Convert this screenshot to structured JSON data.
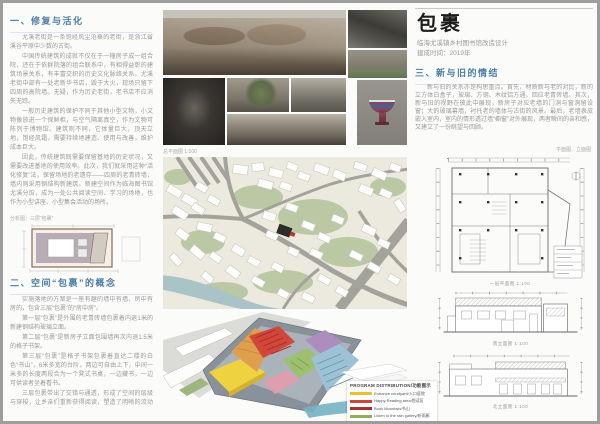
{
  "header": {
    "title": "包裹",
    "subtitle": "临海尤溪镇乡村图书馆改造设计",
    "completion": "建成时间：2019年"
  },
  "section1": {
    "heading": "一、修复与活化",
    "paragraphs": [
      "尤溪老街是一条饱经风尘沧桑的老街，是浙江省溪谷平原中少数的古街。",
      "中国传统建筑的成就不仅在于一幢房子成一组合院，还在于依群院落的组合联系中，有相得益彰的建筑场景关系，有丰富交织的历史文化脉络关系。尤溪老街中部有一处老新华书店，毁于大火，现场只留下四周的高院墙。无疑，作为历史老街，老书店不应消失无踪。",
      "一般历史建筑的保护不同于其他小型文物，小文物像放进一个保鲜柜，与空气隔离真空，作为文物可陈列于博物馆。建筑则不同，它体量巨大，顶天立地，饱经风霜，需要持续地建造、使用与改善，维护成本巨大。",
      "因此，传统建筑既需要保留基地的历史状况，又需要改进基地的使用效率。此次，我们就采用这种“活化修复”法，保留场地的老遗存——四周的老青砖墙，墙内则采用钢结构新建筑。新建空间作为临海图书馆尤溪分馆，成为一处公共阅读空间、学习的场地，也作为小型讲座、小型集会活动的场所。"
    ],
    "diagram_caption": "分析图：三层“包裹”"
  },
  "section2": {
    "heading": "二、空间“包裹”的概念",
    "paragraphs": [
      "实施落地的方案是一座有趣的墙中有墙、房中有房的，包含三层“包裹”的“房中房”。",
      "第一层“包裹”是外围的老青砖墙包裹着内退1米的新建钢结构玻璃立面。",
      "第二层“包裹”是新房子立面包围墙再次内退1.5米的格子书架。",
      "第三层“包裹”是格子书架包裹着直达二楼的白色“书山”，6米多宽的台阶，两边可自由上下，中间一米多的长度两段合为一个凳式书桌，一边藏书，一边可供读者坐着看书。",
      "三层包裹带出了交错与通透，形成了空间的层级与穿梭，让乡亲们重新获得阅读，塑造了明晰的流动与静谧，回味与回顾，留白与古真。"
    ]
  },
  "section3": {
    "heading": "三、新与旧的情结",
    "paragraphs": [
      "新与旧的关系亦是构思重点。首先，材质新与老的对比，新的立方体白盒子，玻璃、方钢、木纹铝方通，回应老青砖墙。其次，新与旧的视野在彼此中展现，新房子对应老墙的门洞与窗洞留设窗；大的玻璃幕墙，衬托老的墙体与古街的风景。最后，老墙表皮嵌入室内，室内的情形透过墙“橱窗”对外展现，两者瞬间的亲和感，又建立了一份眺望与回顾。"
    ],
    "drawings_caption": "平面图、立面图"
  },
  "middle": {
    "siteplan_caption": "总平面图 1:500"
  },
  "axon": {
    "legend_title": "PROGRAM DISTRIBUTION/功能图示",
    "legend": [
      {
        "label": "Entrance courtyard/入口庭院",
        "color": "#e6c233"
      },
      {
        "label": "Happy Reading area/悦读区",
        "color": "#d2453a"
      },
      {
        "label": "Book Mountain/书山",
        "color": "#a33327"
      },
      {
        "label": "Listen to the rain gallery/听雨廊",
        "color": "#8fae58"
      },
      {
        "label": "Courtyard landscape/庭院景观",
        "color": "#7ba6ba"
      },
      {
        "label": "Office/办公",
        "color": "#9b7cb3"
      }
    ]
  },
  "drawings": {
    "plan_caption": "一层平面图 1:100",
    "elev1_caption": "南立面图 1:100",
    "elev2_caption": "北立面图 1:100"
  },
  "colors": {
    "heading_accent": "#4a7da8",
    "body_text": "#9a9a9a",
    "site_marker": "#b23a2e"
  }
}
